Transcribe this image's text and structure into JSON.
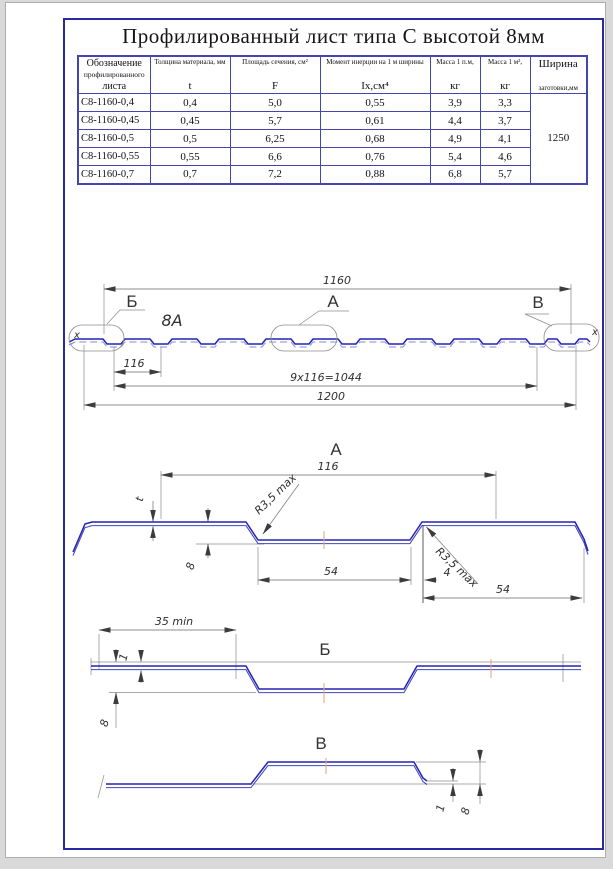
{
  "title": "Профилированный лист типа С высотой 8мм",
  "table": {
    "col1_header": [
      "Обозначение",
      "профилированного",
      "листа"
    ],
    "columns": [
      {
        "label": "Толщина материала, мм",
        "unit": "t"
      },
      {
        "label": "Площадь сечения, см²",
        "unit": "F"
      },
      {
        "label": "Момент инерции на 1 м ширины",
        "unit": "Iх,см⁴"
      },
      {
        "label": "Масса 1 п.м,",
        "unit": "кг"
      },
      {
        "label": "Масса 1 м²,",
        "unit": "кг"
      },
      {
        "label": "Ширина",
        "unit": "заготовки,мм"
      }
    ],
    "rows": [
      [
        "С8-1160-0,4",
        "0,4",
        "5,0",
        "0,55",
        "3,9",
        "3,3"
      ],
      [
        "С8-1160-0,45",
        "0,45",
        "5,7",
        "0,61",
        "4,4",
        "3,7"
      ],
      [
        "С8-1160-0,5",
        "0,5",
        "6,25",
        "0,68",
        "4,9",
        "4,1"
      ],
      [
        "С8-1160-0,55",
        "0,55",
        "6,6",
        "0,76",
        "5,4",
        "4,6"
      ],
      [
        "С8-1160-0,7",
        "0,7",
        "7,2",
        "0,88",
        "6,8",
        "5,7"
      ]
    ],
    "blank_width": "1250"
  },
  "section": {
    "dim_width": "1160",
    "dim_pitch_single": "116",
    "dim_pitch_total": "9x116=1044",
    "dim_overall": "1200",
    "callout_b": "Б",
    "callout_a": "А",
    "callout_v": "В",
    "note": "8А",
    "axis_left": "x",
    "axis_right": "x"
  },
  "detail_a": {
    "title": "А",
    "dim_pitch": "116",
    "dim_thickness": "t",
    "radius_top": "R3,5 max",
    "radius_bottom": "R3,5 max",
    "dim_height": "8",
    "dim_flat_bottom": "54",
    "dim_step": "4",
    "dim_flat_top": "54"
  },
  "detail_b": {
    "title": "Б",
    "dim_edge": "35 min",
    "dim_offset": "1",
    "dim_height": "8"
  },
  "detail_v": {
    "title": "В",
    "dim_offset": "1",
    "dim_height": "8"
  },
  "colors": {
    "profile_blue": "#2424b4",
    "frame_blue": "#2a2a9e",
    "table_border_blue": "#4545b0",
    "dim_gray": "#8c8c8c",
    "arrow_dark": "#3c3c3c",
    "center_mark_orange": "#e4a87e"
  }
}
